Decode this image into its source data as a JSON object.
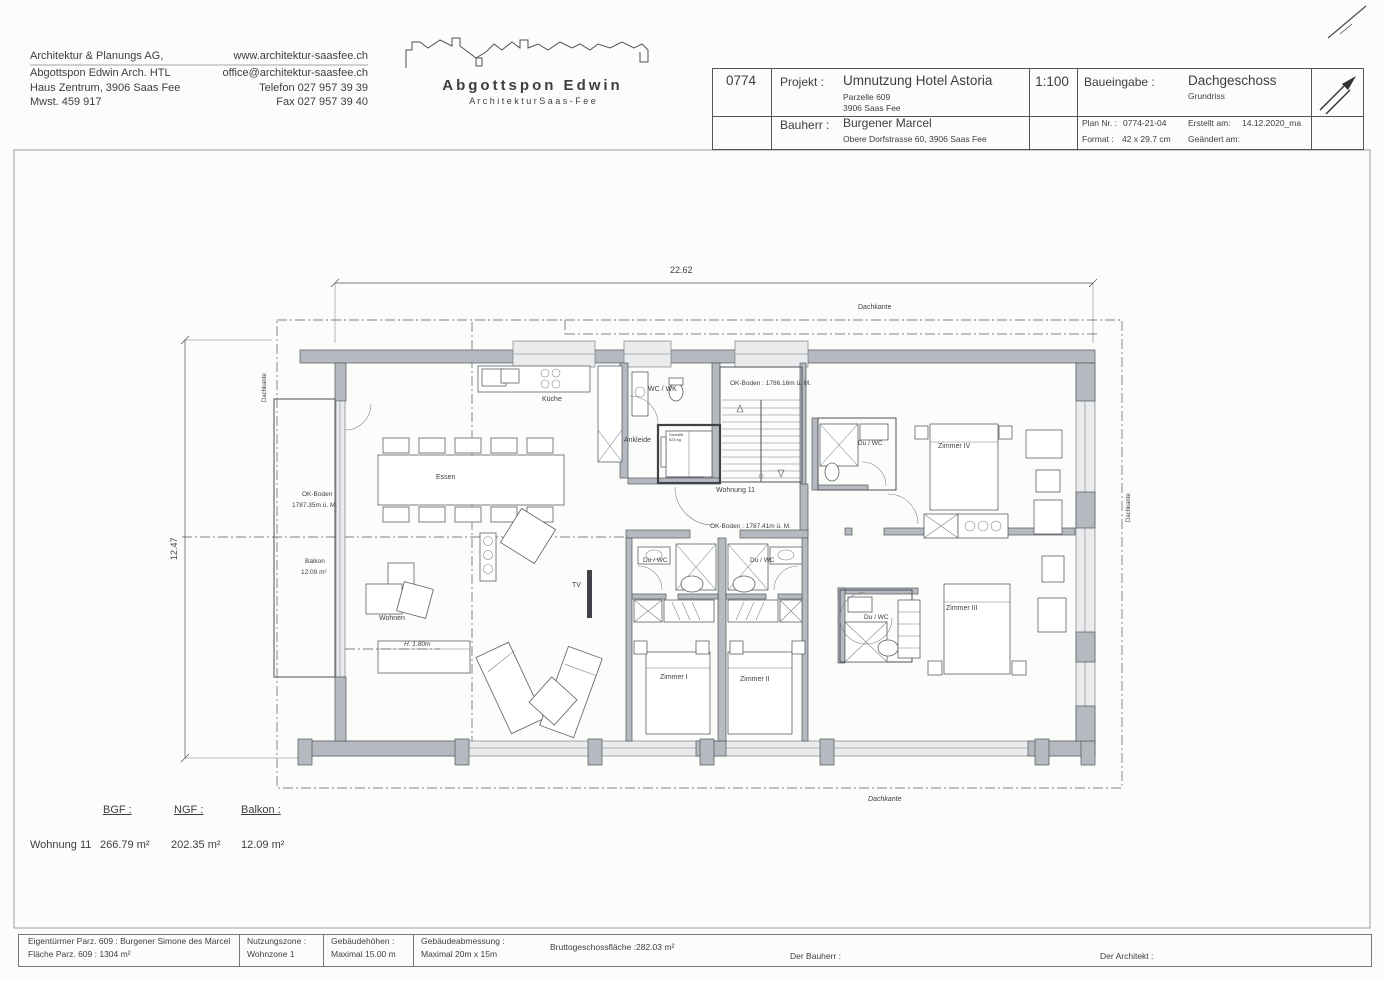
{
  "header": {
    "firm": {
      "line1": "Architektur & Planungs AG,",
      "line2": "Abgottspon Edwin Arch. HTL",
      "line3": "Haus Zentrum, 3906 Saas Fee",
      "line4": "Mwst. 459 917"
    },
    "contact": {
      "web": "www.architektur-saasfee.ch",
      "email": "office@architektur-saasfee.ch",
      "phone": "Telefon  027 957 39 39",
      "fax": "Fax  027 957 39 40"
    },
    "logo": {
      "name": "Abgottspon Edwin",
      "subtitle": "A r c h i t e k t u r     S a a s - F e e"
    },
    "titleblock": {
      "number": "0774",
      "projekt_label": "Projekt :",
      "projekt": "Umnutzung Hotel Astoria",
      "projekt_sub1": "Parzelle 609",
      "projekt_sub2": "3906 Saas Fee",
      "scale": "1:100",
      "baueingabe_label": "Baueingabe :",
      "phase": "Dachgeschoss",
      "phase_sub": "Grundriss",
      "bauherr_label": "Bauherr :",
      "bauherr": "Burgener Marcel",
      "bauherr_sub": "Obere Dorfstrasse 60, 3906 Saas Fee",
      "plan_nr_label": "Plan Nr. :",
      "plan_nr": "0774-21-04",
      "erstellt_label": "Erstellt am:",
      "erstellt": "14.12.2020_ma",
      "format_label": "Format :",
      "format": "42 x 29.7 cm",
      "geaendert_label": "Geändert am:"
    }
  },
  "plan": {
    "dim_width": "22.62",
    "dim_height": "12.47",
    "labels": {
      "dachkante": "Dachkante",
      "kueche": "Küche",
      "essen": "Essen",
      "wohnen": "Wohnen",
      "tv": "TV",
      "h180": "H. 1.80m",
      "wc_wk": "WC / WK",
      "ankleide": "Ankleide",
      "wohnung": "Wohnung 11",
      "ok_boden_stair": "OK-Boden : 1786.16m ü. M.",
      "ok_boden_mid": "OK-Boden : 1787.41m ü. M.",
      "ok_boden_balkon1": "OK-Boden",
      "ok_boden_balkon2": "1787.35m ü. M.",
      "balkon1": "Balkon",
      "balkon2": "12.09 m²",
      "du_wc": "Du / WC",
      "zimmer1": "Zimmer I",
      "zimmer2": "Zimmer II",
      "zimmer3": "Zimmer III",
      "zimmer4": "Zimmer IV",
      "lift1": "Duwalift",
      "lift2": "625 kg"
    }
  },
  "summary": {
    "headers": {
      "bgf": "BGF :",
      "ngf": "NGF :",
      "balkon": "Balkon :"
    },
    "row": {
      "name": "Wohnung 11",
      "bgf": "266.79 m²",
      "ngf": "202.35 m²",
      "balkon": "12.09 m²"
    }
  },
  "footer": {
    "col1a": "Eigentürmer Parz. 609 : Burgener Simone des Marcel",
    "col1b": "Fläche Parz. 609 : 1304 m²",
    "col2a": "Nutzungszone :",
    "col2b": "Wohnzone 1",
    "col3a": "Gebäudehöhen :",
    "col3b": "Maximal 15.00 m",
    "col4a": "Gebäudeabmessung :",
    "col4b": "Maximal 20m x 15m",
    "col5a": "Bruttogeschossfläche :",
    "col5b": "282.03 m²",
    "bauherr": "Der Bauherr :",
    "architekt": "Der Architekt :"
  }
}
